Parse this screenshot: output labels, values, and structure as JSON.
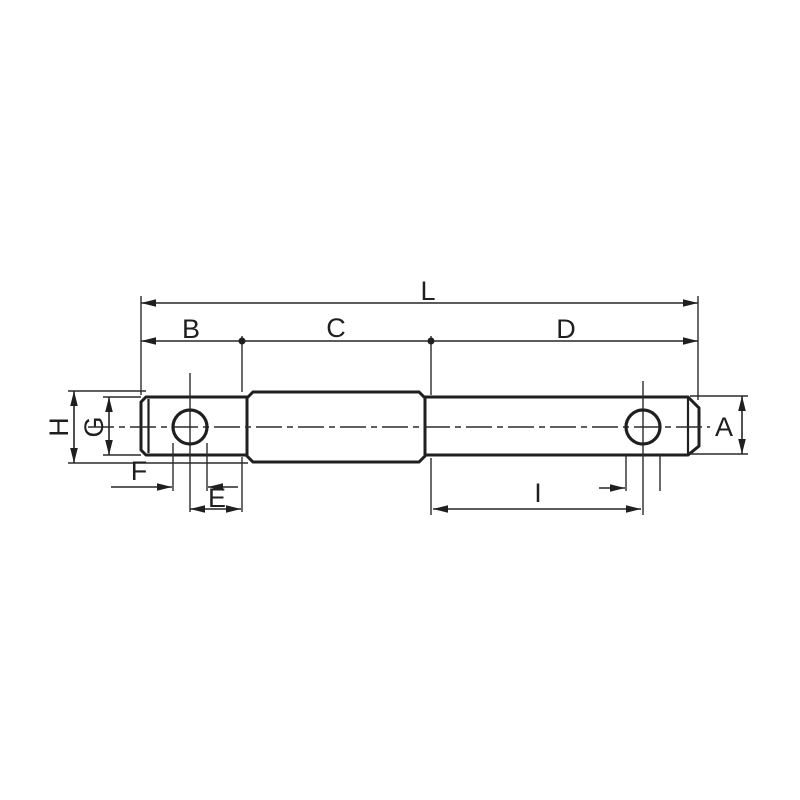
{
  "drawing": {
    "colors": {
      "background": "#ffffff",
      "line": "#1f1f1f"
    },
    "labels": {
      "L": "L",
      "B": "B",
      "C": "C",
      "D": "D",
      "H": "H",
      "G": "G",
      "A": "A",
      "F": "F",
      "E": "E",
      "I": "I"
    }
  }
}
